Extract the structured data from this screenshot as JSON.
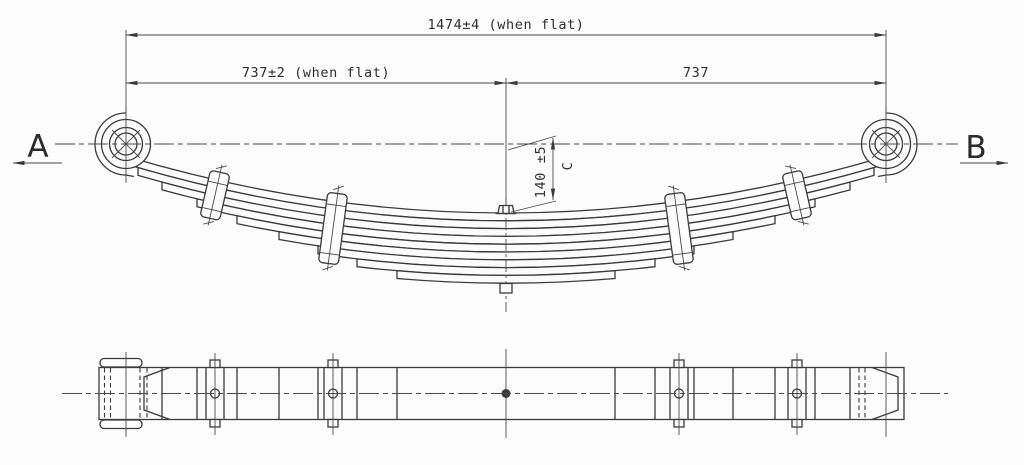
{
  "drawing": {
    "type": "engineering-drawing",
    "subject": "multi-leaf suspension spring: side elevation (curved leaf stack) and bottom plan view",
    "background_color": "#fcfcfc",
    "line_color": "#3a3a3a",
    "side_view": {
      "dim_overall": "1474±4 (when flat)",
      "dim_left": "737±2 (when flat)",
      "dim_right": "737",
      "dim_height": "140 ±5",
      "dim_height_ref": "C",
      "label_a": "A",
      "label_b": "B",
      "leaf_count": 9,
      "clamp_count": 4,
      "eyes": 2,
      "center_bolt": true
    },
    "plan_view": {
      "clamp_count": 4,
      "center_bolt": true,
      "hidden_eye_lines": true
    }
  }
}
